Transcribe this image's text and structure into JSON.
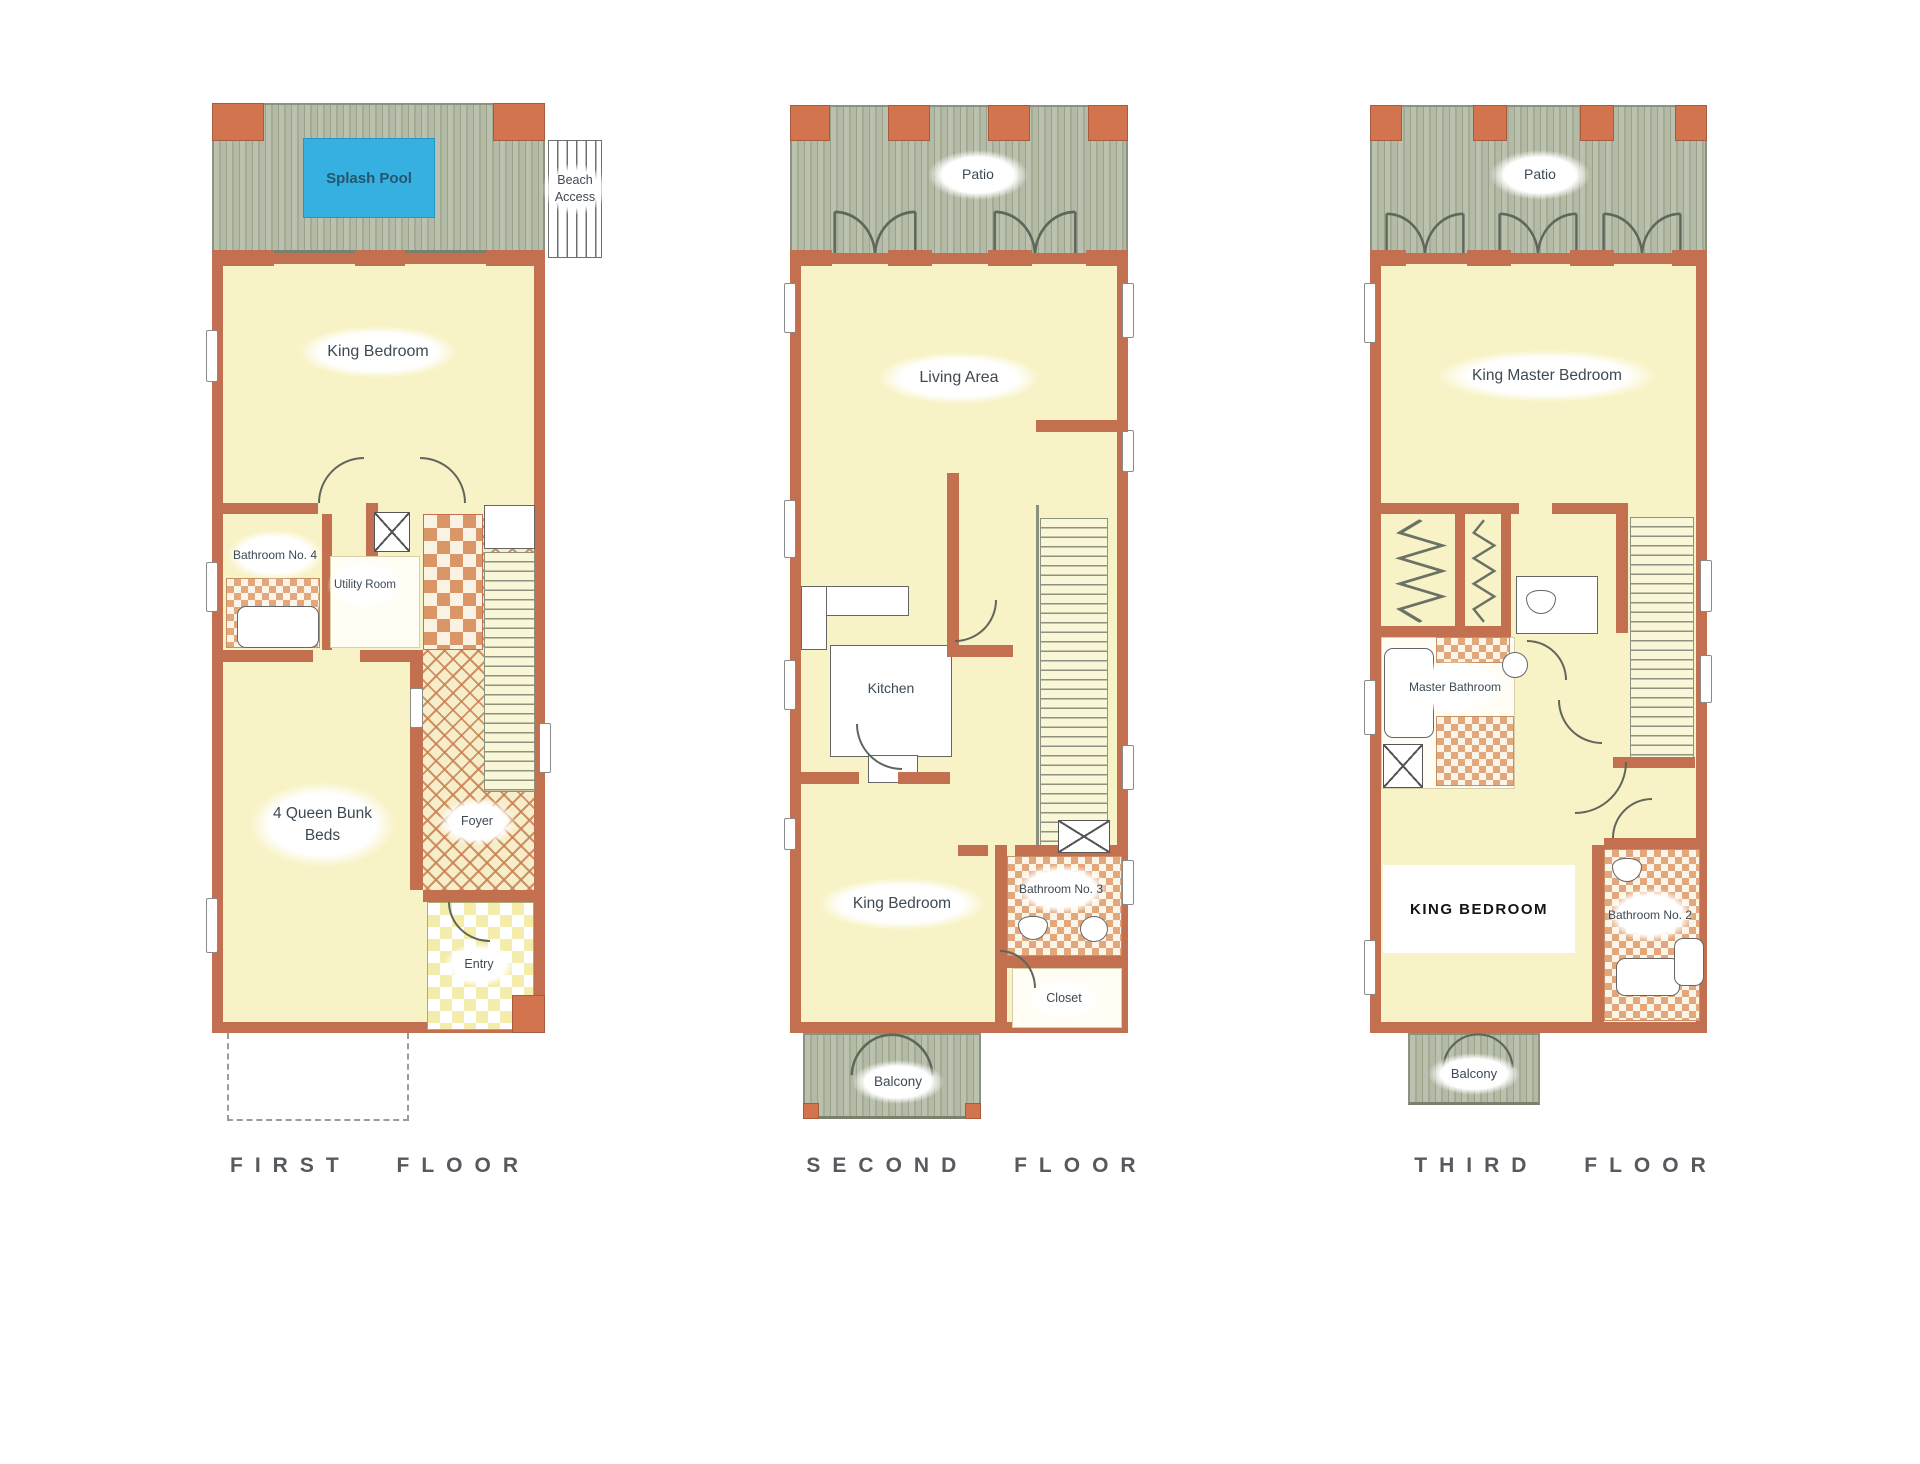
{
  "document": {
    "type": "three-story beach house floor plan"
  },
  "colors": {
    "wall": "#c2704f",
    "wall_post": "#d2744e",
    "floor": "#f8f3c6",
    "deck": "#b3baa5",
    "pool": "#35b0e1",
    "tile": "#db9668",
    "label_text": "#3d4a54",
    "title_text": "#56595e"
  },
  "floors": [
    {
      "title": "FIRST FLOOR",
      "rooms": {
        "pool": "Splash Pool",
        "beach_access": "Beach Access",
        "king_bedroom": "King Bedroom",
        "bathroom": "Bathroom No. 4",
        "utility": "Utility Room",
        "bunk": "4 Queen Bunk Beds",
        "foyer": "Foyer",
        "entry": "Entry"
      }
    },
    {
      "title": "SECOND FLOOR",
      "rooms": {
        "patio": "Patio",
        "living": "Living Area",
        "kitchen": "Kitchen",
        "king_bedroom": "King Bedroom",
        "bathroom": "Bathroom No. 3",
        "closet": "Closet",
        "balcony": "Balcony"
      }
    },
    {
      "title": "THIRD FLOOR",
      "rooms": {
        "patio": "Patio",
        "master_bedroom": "King Master Bedroom",
        "master_bathroom": "Master Bathroom",
        "king_bedroom": "KING BEDROOM",
        "bathroom": "Bathroom No. 2",
        "balcony": "Balcony"
      }
    }
  ]
}
